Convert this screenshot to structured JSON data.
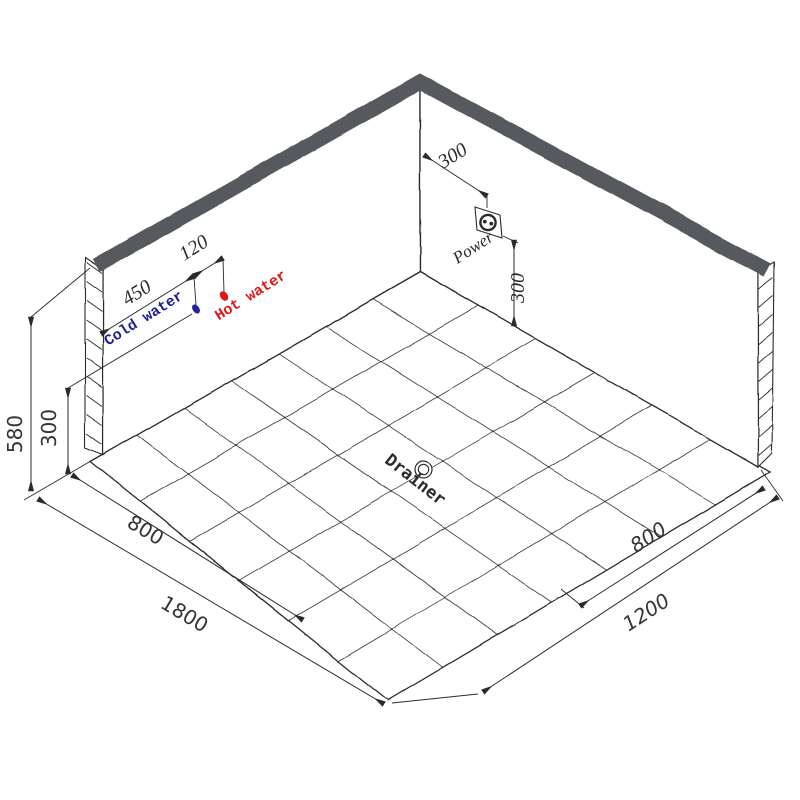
{
  "labels": {
    "cold_water": "Cold water",
    "hot_water": "Hot water",
    "power": "Power",
    "drainer": "Drainer"
  },
  "dimensions": {
    "cold_water_offset": "450",
    "hot_cold_gap": "120",
    "left_wall_height": "580",
    "water_outlet_height": "300",
    "power_offset_from_corner": "300",
    "power_outlet_height": "300",
    "floor_left_drain_offset": "800",
    "floor_left_length": "1800",
    "floor_right_drain_offset": "800",
    "floor_right_length": "1200"
  },
  "colors": {
    "wall_top_band": "#575a5e",
    "drawing_line": "#2b2b2b",
    "cold_water": "#1d1d92",
    "hot_water": "#e11717"
  },
  "figure": {
    "floor": {
      "back": [
        420,
        272
      ],
      "left": [
        90,
        462
      ],
      "front": [
        388,
        700
      ],
      "right": [
        770,
        472
      ],
      "tiles_along_left_wall": 7,
      "tiles_along_right_wall": 6
    },
    "hatch_left": {
      "x1": 86.5,
      "x2": 102,
      "y_start": 263,
      "drop": 11,
      "step": 19,
      "count": 10
    },
    "hatch_right": {
      "x1": 758.5,
      "x2": 772.5,
      "y_start": 289,
      "drop": -12,
      "step": 18.5,
      "count": 10
    }
  }
}
